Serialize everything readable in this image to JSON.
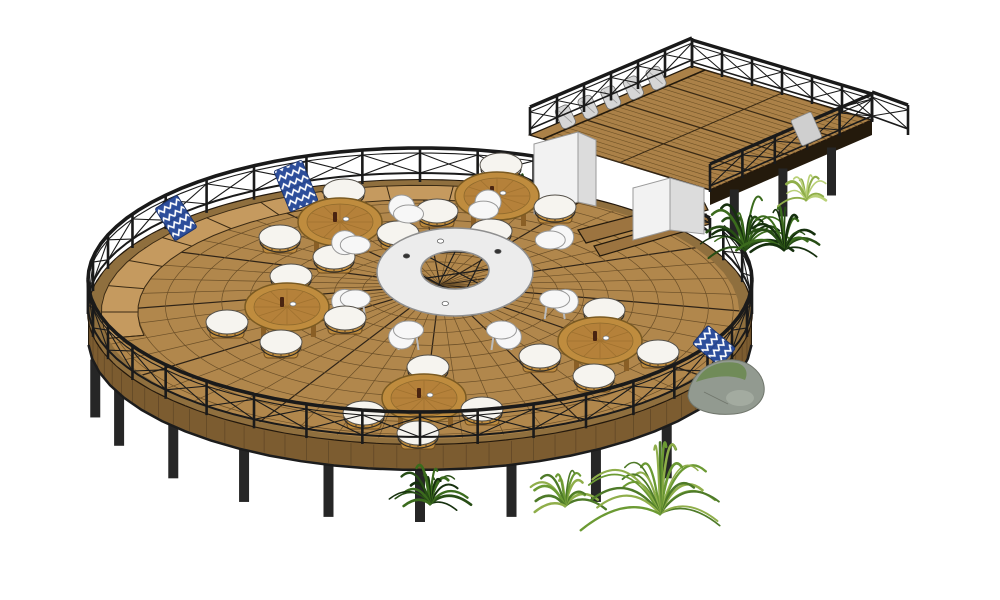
{
  "colors": {
    "background": "#ffffff",
    "deckWood": "#b1874c",
    "deckLine": "#6b4f28",
    "deckBold": "#2e2317",
    "deckEdge": "#8f6f3e",
    "benchWood": "#c59a5f",
    "fascia": "#7c5c30",
    "fasciaTick": "#5e4525",
    "railing": "#1a1a1a",
    "post": "#262626",
    "rectDeck": "#ab8148",
    "rectPlank": "#6f5226",
    "rectSeam": "#3a2a14",
    "tableWood": "#bf8c3e",
    "tableInner": "#b5813a",
    "tableRim": "#7a5a22",
    "stoolCushion": "#f6f4ef",
    "ringTable": "#ececec",
    "chairWhite": "#f7f7f7",
    "towelBlue": "#2d4e9b",
    "towelZig": "#ffffff",
    "grayTowel": "#cfcfcf",
    "pillowGray": "#d6d6d6",
    "wallWhite": "#f2f2f2",
    "wallSide": "#dcdcdc",
    "stepWood": "#9c7440",
    "rockGray": "#929a90",
    "rockMoss": "#6d8a52",
    "rockLight": "#a8afa4",
    "plantDark1": "#16300e",
    "plantDark2": "#274d15",
    "plantDark3": "#3b6b1d",
    "plantLight1": "#4e7a28",
    "plantLight2": "#8fae4a",
    "plantLight3": "#6b9a33",
    "plantPale1": "#b9d077",
    "plantPale2": "#8fae4a"
  },
  "scene": {
    "deck": {
      "cx": 420,
      "cy": 312,
      "rx": 332,
      "ry": 132,
      "webCx": 440,
      "webCy": 285
    },
    "circle_posts_deg": [
      42,
      58,
      74,
      90,
      106,
      122,
      138,
      155,
      168
    ],
    "railing_far": [
      [
        180,
        300
      ],
      [
        336,
        360
      ]
    ],
    "railing_near": [
      [
        0,
        180
      ]
    ],
    "bench_arc": [
      168,
      300
    ],
    "rect_deck": {
      "W": [
        530,
        135
      ],
      "N": [
        692,
        66
      ],
      "E": [
        872,
        120
      ],
      "S": [
        710,
        190
      ]
    },
    "pillow_ts": [
      0.16,
      0.3,
      0.44,
      0.58,
      0.72
    ],
    "ring_table": {
      "cx": 455,
      "cy": 272,
      "outerRx": 78,
      "outerRy": 44,
      "innerRx": 34,
      "innerRy": 19,
      "chair_back_deg": [
        205,
        245,
        285,
        330
      ],
      "chair_front_deg": [
        25,
        65,
        115,
        155
      ]
    },
    "tables": [
      [
        497,
        196
      ],
      [
        340,
        222
      ],
      [
        287,
        307
      ],
      [
        600,
        341
      ],
      [
        424,
        398
      ]
    ],
    "stool_offsets": [
      [
        4,
        -30
      ],
      [
        -60,
        16
      ],
      [
        58,
        12
      ],
      [
        -6,
        36
      ]
    ],
    "towels_left": [
      {
        "x": 176,
        "y": 218,
        "rot": -32,
        "w": 26,
        "h": 38
      },
      {
        "x": 296,
        "y": 186,
        "rot": -22,
        "w": 30,
        "h": 44
      }
    ],
    "towel_right": {
      "x": 714,
      "y": 346,
      "rot": -50,
      "w": 24,
      "h": 36
    },
    "rock": {
      "x": 724,
      "y": 390
    },
    "steps": [
      [
        [
          578,
          230
        ],
        [
          702,
          198
        ],
        [
          708,
          210
        ],
        [
          586,
          243
        ]
      ],
      [
        [
          594,
          246
        ],
        [
          706,
          214
        ],
        [
          710,
          224
        ],
        [
          600,
          256
        ]
      ]
    ],
    "step_rail": {
      "a": [
        652,
        206
      ],
      "b": [
        710,
        236
      ],
      "h": 18
    },
    "walls": [
      {
        "pts": [
          [
            534,
            144
          ],
          [
            578,
            132
          ],
          [
            578,
            202
          ],
          [
            534,
            214
          ]
        ],
        "side": false
      },
      {
        "pts": [
          [
            578,
            132
          ],
          [
            596,
            140
          ],
          [
            596,
            206
          ],
          [
            578,
            202
          ]
        ],
        "side": true
      },
      {
        "pts": [
          [
            633,
            188
          ],
          [
            670,
            178
          ],
          [
            670,
            230
          ],
          [
            633,
            240
          ]
        ],
        "side": false
      },
      {
        "pts": [
          [
            670,
            178
          ],
          [
            704,
            188
          ],
          [
            704,
            234
          ],
          [
            670,
            230
          ]
        ],
        "side": true
      }
    ],
    "plants_back": [
      {
        "x": 520,
        "y": 196,
        "r": 28,
        "type": "dark",
        "fronds": 10
      }
    ],
    "plants_junction": [
      {
        "x": 745,
        "y": 250,
        "r": 62,
        "type": "dark",
        "fronds": 20
      },
      {
        "x": 784,
        "y": 250,
        "r": 50,
        "type": "dark",
        "fronds": 16
      },
      {
        "x": 806,
        "y": 200,
        "r": 30,
        "type": "pale",
        "fronds": 10
      }
    ],
    "plants_foreground": [
      {
        "x": 430,
        "y": 504,
        "r": 48,
        "type": "dark",
        "fronds": 18
      },
      {
        "x": 565,
        "y": 506,
        "r": 46,
        "type": "light",
        "fronds": 14
      },
      {
        "x": 660,
        "y": 514,
        "r": 88,
        "type": "light",
        "fronds": 24
      }
    ]
  }
}
